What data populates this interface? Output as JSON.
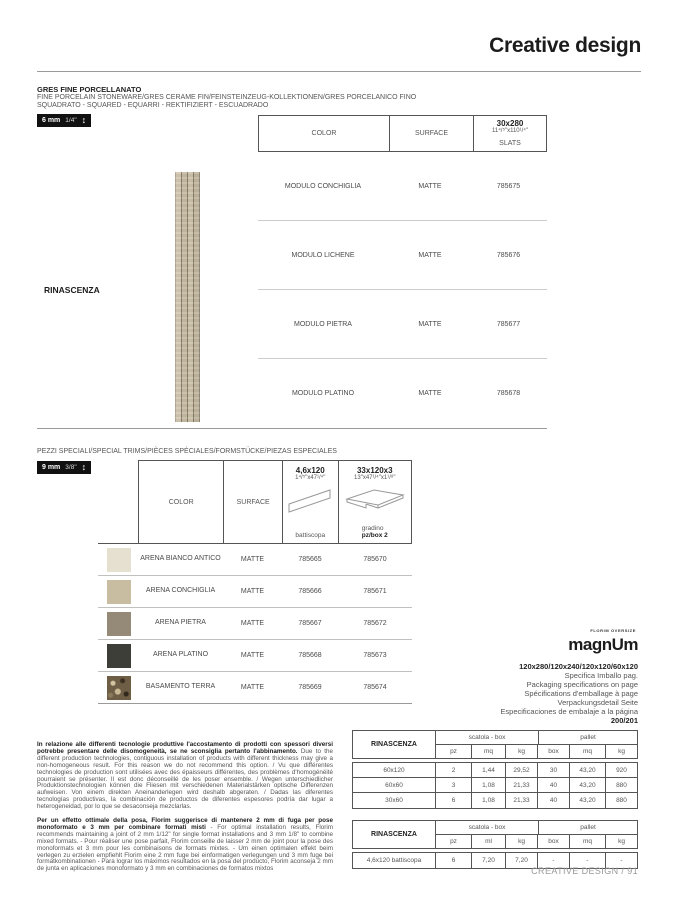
{
  "header": {
    "title": "Creative design"
  },
  "section1": {
    "title": "GRES FINE PORCELLANATO",
    "subtitle1": "FINE PORCELAIN STONEWARE/GRES CERAME FIN/FEINSTEINZEUG-KOLLEKTIONEN/GRES PORCELANICO FINO",
    "subtitle2": "SQUADRATO - SQUARED - EQUARRI - REKTIFIZIERT - ESCUADRADO",
    "thickness": {
      "mm": "6 mm",
      "inch": "1/4\"",
      "arrow": "↕"
    },
    "series": "RINASCENZA",
    "table": {
      "col_color": "COLOR",
      "col_surface": "SURFACE",
      "size_label": "30x280",
      "size_inches": "11⁴/⁵\"x110¹/⁴\"",
      "size_sub": "SLATS",
      "rows": [
        {
          "color": "MODULO CONCHIGLIA",
          "surface": "MATTE",
          "code": "785675"
        },
        {
          "color": "MODULO LICHENE",
          "surface": "MATTE",
          "code": "785676"
        },
        {
          "color": "MODULO PIETRA",
          "surface": "MATTE",
          "code": "785677"
        },
        {
          "color": "MODULO PLATINO",
          "surface": "MATTE",
          "code": "785678"
        }
      ]
    }
  },
  "section2": {
    "title": "PEZZI SPECIALI/SPECIAL TRIMS/PIÈCES SPÉCIALES/FORMSTÜCKE/PIEZAS ESPECIALES",
    "thickness": {
      "mm": "9 mm",
      "inch": "3/8\"",
      "arrow": "↕"
    },
    "table": {
      "col_color": "COLOR",
      "col_surface": "SURFACE",
      "size1_label": "4,6x120",
      "size1_inches": "1⁴/⁵\"x47¹/⁴\"",
      "size1_caption": "battiscopa",
      "size2_label": "33x120x3",
      "size2_inches": "13\"x47¹/⁴\"x1¹/⁸\"",
      "size2_caption": "gradino",
      "size2_caption2": "pz/box 2",
      "rows": [
        {
          "color": "ARENA BIANCO ANTICO",
          "surface": "MATTE",
          "code1": "785665",
          "code2": "785670",
          "swatch": "#e6e0d0"
        },
        {
          "color": "ARENA CONCHIGLIA",
          "surface": "MATTE",
          "code1": "785666",
          "code2": "785671",
          "swatch": "#c9bda1"
        },
        {
          "color": "ARENA PIETRA",
          "surface": "MATTE",
          "code1": "785667",
          "code2": "785672",
          "swatch": "#948a77"
        },
        {
          "color": "ARENA PLATINO",
          "surface": "MATTE",
          "code1": "785668",
          "code2": "785673",
          "swatch": "#3c3e37"
        },
        {
          "color": "BASAMENTO TERRA",
          "surface": "MATTE",
          "code1": "785669",
          "code2": "785674",
          "swatch": "#6f5e46"
        }
      ]
    }
  },
  "magnum": {
    "brand_small": "FLORIM OVERSIZE",
    "brand_pre": "magn",
    "brand_u": "U",
    "brand_post": "m",
    "formats": "120x280/120x240/120x120/60x120",
    "lines": [
      "Specifica Imballo pag.",
      "Packaging specifications on page",
      "Spécifications d'emballage à page",
      "Verpackungsdetail Seite",
      "Especificaciones de embalaje a la página"
    ],
    "pages": "200/201"
  },
  "notes": [
    {
      "bold": "In relazione alle differenti tecnologie produttive l'accostamento di prodotti con spessori diversi potrebbe presentare delle disomogeneità, se ne sconsiglia pertanto l'abbinamento.",
      "text": " Due to the different production technologies, contiguous installation of products with different thickness may give a non-homogeneous result. For this reason we do not recommend this option. / Vu que différentes technologies de production sont utilisées avec des épaisseurs différentes, des problèmes d'homogénéité pourraient se présenter. Il est donc déconseillé de les poser ensemble. / Wegen unterschiedlicher Produktionstechnologien können die Fliesen mit verschiedenen Materialstärken optische Differenzen aufweisen. Von einem direkten Aneinanderlegen wird deshalb abgeraten. / Dadas las diferentes tecnologías productivas, la combinación de productos de diferentes espesores podría dar lugar a heterogeneidad, por lo que se desaconseja mezclarlas."
    },
    {
      "bold": "Per un effetto ottimale della posa, Florim suggerisce di mantenere 2 mm di fuga per pose monoformato e 3 mm per combinare formati misti",
      "text": " - For optimal installation results, Florim recommends maintaining a joint of 2 mm 1/12\" for single format installations and 3 mm 1/8\" to combine mixed formats. - Pour réaliser une pose parfait, Florim conseille de laisser 2 mm de joint pour la pose des monoformats et 3 mm pour les combinaisons de formats mixtes. - Um einen optimalen effekt beim verlegen zu erzielen empfiehlt Florim eine 2 mm fuge bei einformatigen verlegungen und 3 mm fuge bei formatkombinationen - Para lograr los máximos resultados en la posa del producto, Florim aconseja 2 mm de junta en aplicaciones monoformato y 3 mm en combinaciones de formatos mixtos"
    }
  ],
  "packing": {
    "tableA": {
      "series": "RINASCENZA",
      "group1": "scatola - box",
      "group2": "pallet",
      "sub": [
        "pz",
        "mq",
        "kg",
        "box",
        "mq",
        "kg"
      ],
      "rows": [
        [
          "60x120",
          "2",
          "1,44",
          "29,52",
          "30",
          "43,20",
          "920"
        ],
        [
          "60x60",
          "3",
          "1,08",
          "21,33",
          "40",
          "43,20",
          "880"
        ],
        [
          "30x60",
          "6",
          "1,08",
          "21,33",
          "40",
          "43,20",
          "880"
        ]
      ]
    },
    "tableB": {
      "series": "RINASCENZA",
      "group1": "scatola - box",
      "group2": "pallet",
      "sub": [
        "pz",
        "ml",
        "kg",
        "box",
        "mq",
        "kg"
      ],
      "rows": [
        [
          "4,6x120 battiscopa",
          "6",
          "7,20",
          "7,20",
          "-",
          "-",
          "-"
        ]
      ]
    }
  },
  "footer": {
    "text": "CREATIVE DESIGN / 91"
  }
}
